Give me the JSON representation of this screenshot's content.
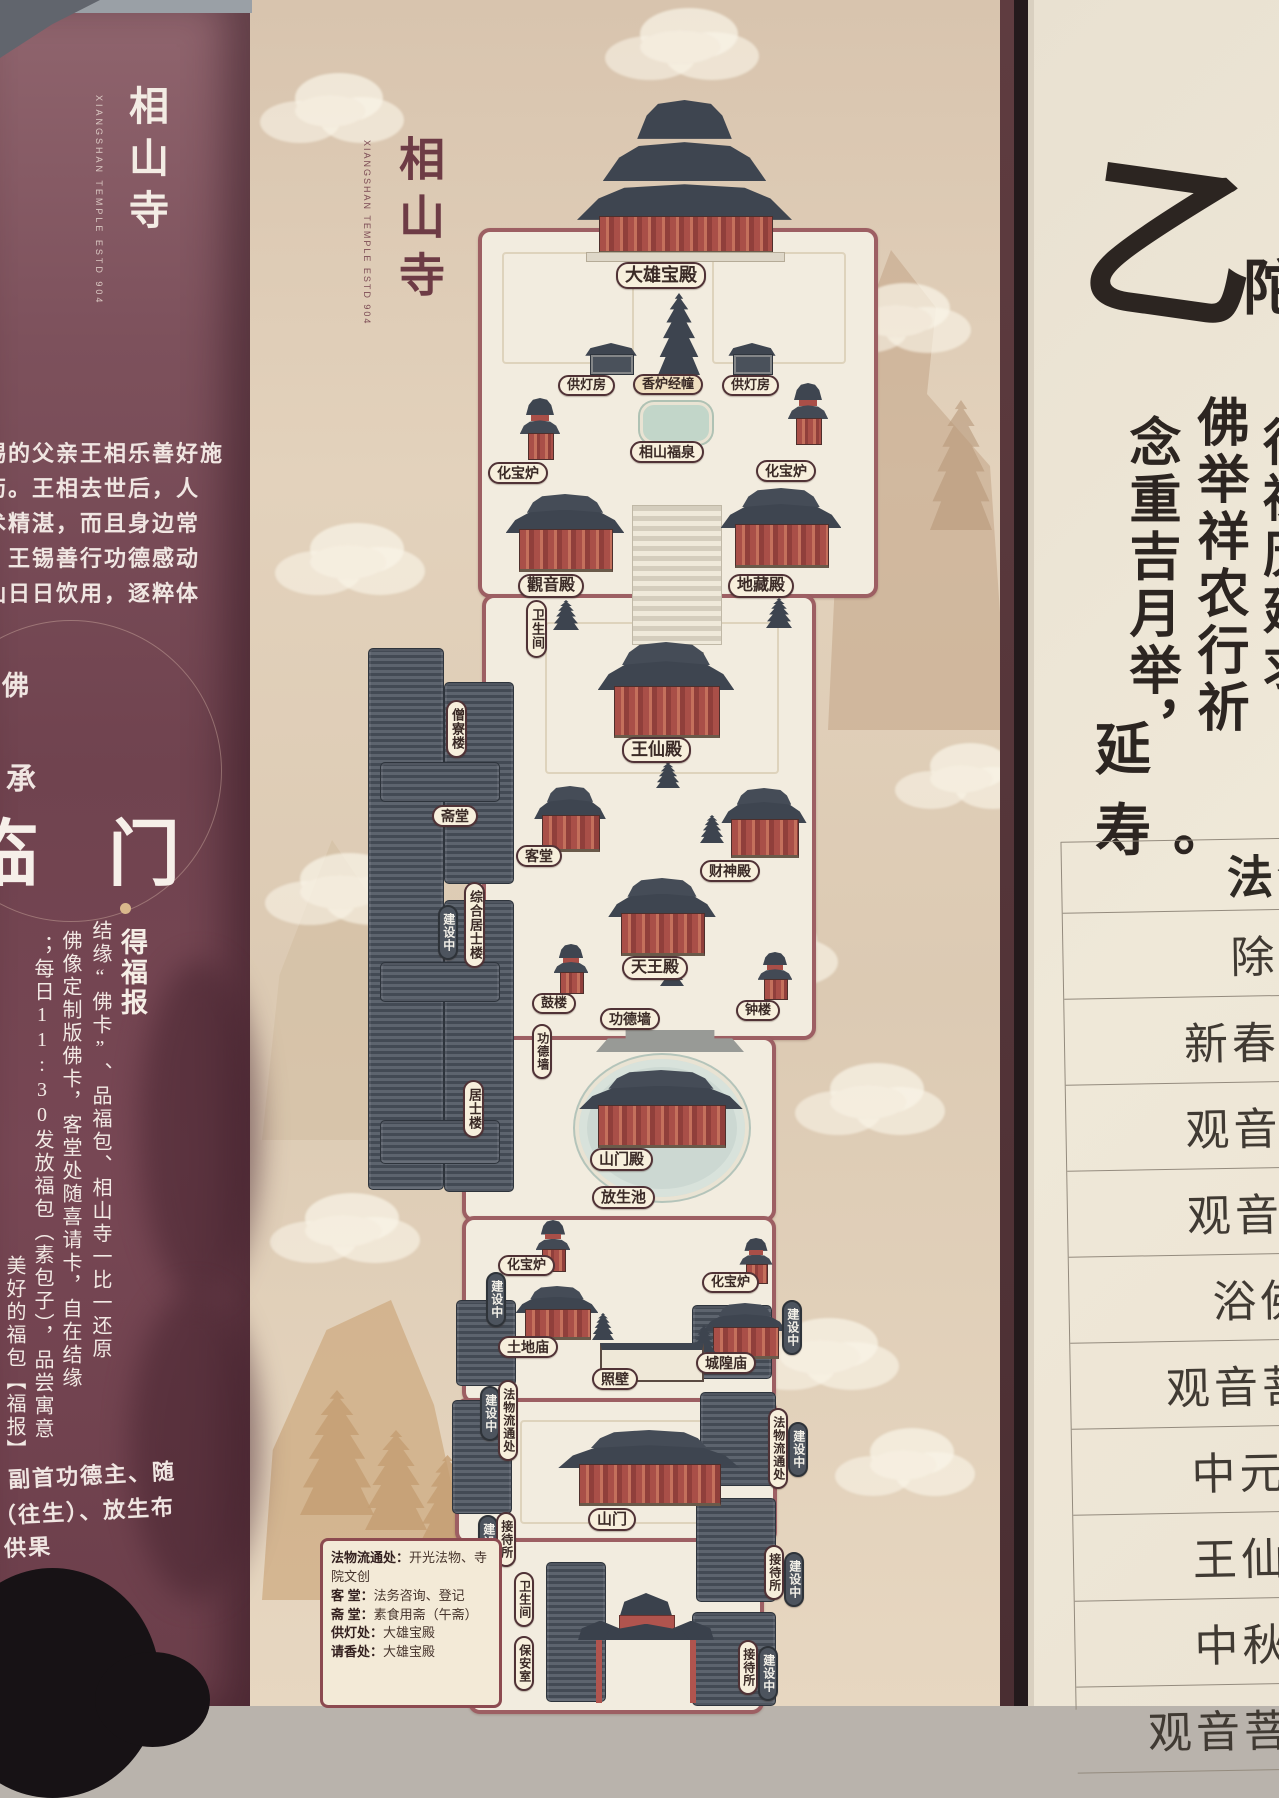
{
  "left_panel": {
    "title": "相山寺",
    "title_sub": "XIANGSHAN TEMPLE ESTD 904",
    "para": [
      "锡的父亲王相乐善好施",
      "药。王相去世后，人",
      "术精湛，而且身边常",
      "。王锡善行功德感动",
      "仙日日饮用，逐粹体"
    ],
    "char_fo": "佛",
    "char_cheng": "承",
    "heading": "临 门",
    "bullet_title": "得福报",
    "cols": [
      "结缘“佛卡”、品福包、相山寺一比一还原",
      "佛像定制版佛卡，客堂处随喜请卡，自在结缘",
      "；每日11:30发放福包（素包子），品尝寓意",
      "美好的福包【福报】"
    ],
    "bottom": [
      "副首功德主、随",
      "（往生）、放生布",
      "供果"
    ]
  },
  "map": {
    "title": "相山寺",
    "subtitle": "XIANGSHAN TEMPLE ESTD 904",
    "labels": {
      "daxiongbaodian": "大雄宝殿",
      "gongdengfang": "供灯房",
      "xiangluijingchuang": "香炉经幢",
      "xiangshanfuquan": "相山福泉",
      "huabaolu": "化宝炉",
      "guanyindian": "觀音殿",
      "dizangdian": "地藏殿",
      "weishengjian": "卫生间",
      "wangxiandian": "王仙殿",
      "sengliaolou": "僧寮楼",
      "zhaitang": "斋堂",
      "ketang": "客堂",
      "caishendian": "财神殿",
      "zonghejushilou": "综合居士楼",
      "jianshezhong": "建设中",
      "tianwangdian": "天王殿",
      "gulou": "鼓楼",
      "gongdeqiang": "功德墙",
      "zhonglou": "钟楼",
      "jushilou": "居士楼",
      "shanmendian": "山门殿",
      "fangshengchi": "放生池",
      "tudimiao": "土地庙",
      "chenghuangmiao": "城隍庙",
      "zhaobi": "照壁",
      "fawuliutongchu": "法物流通处",
      "shanmen": "山门",
      "jiedaisuo": "接待所",
      "baoanshi": "保安室"
    },
    "legend": {
      "rows": [
        {
          "k": "法物流通处：",
          "v": "开光法物、寺院文创"
        },
        {
          "k": "客 堂：",
          "v": "法务咨询、登记"
        },
        {
          "k": "斋 堂：",
          "v": "素食用斋（午斋）"
        },
        {
          "k": "供灯处：",
          "v": "大雄宝殿"
        },
        {
          "k": "请香处：",
          "v": "大雄宝殿"
        }
      ]
    }
  },
  "right_panel": {
    "calligraphy": {
      "big_char": "乙",
      "partial_char": "陀",
      "col_right": "，行祷历延求",
      "col_mid": "佛举祥农行祈",
      "col_left": "念重吉月举，",
      "tail": "延寿。"
    },
    "schedule": {
      "header": "法会",
      "rows": [
        "除夕",
        "新春祈福",
        "观音开库",
        "观音菩萨",
        "浴佛节",
        "观音菩萨成",
        "中元法会",
        "王仙庙会",
        "中秋拜月",
        "观音菩萨出家"
      ]
    }
  },
  "colors": {
    "board_maroon": "#6d414c",
    "map_tan": "#decbb5",
    "paper_cream": "#eae2d2",
    "pill_cream": "#f7efdc",
    "pill_border": "#503236",
    "badge_dark": "#4d545e",
    "wall_maroon": "#9d5f63",
    "roof_slate": "#3e4550",
    "building_red": "#b0544e",
    "pond_green": "#ccd8d2"
  }
}
